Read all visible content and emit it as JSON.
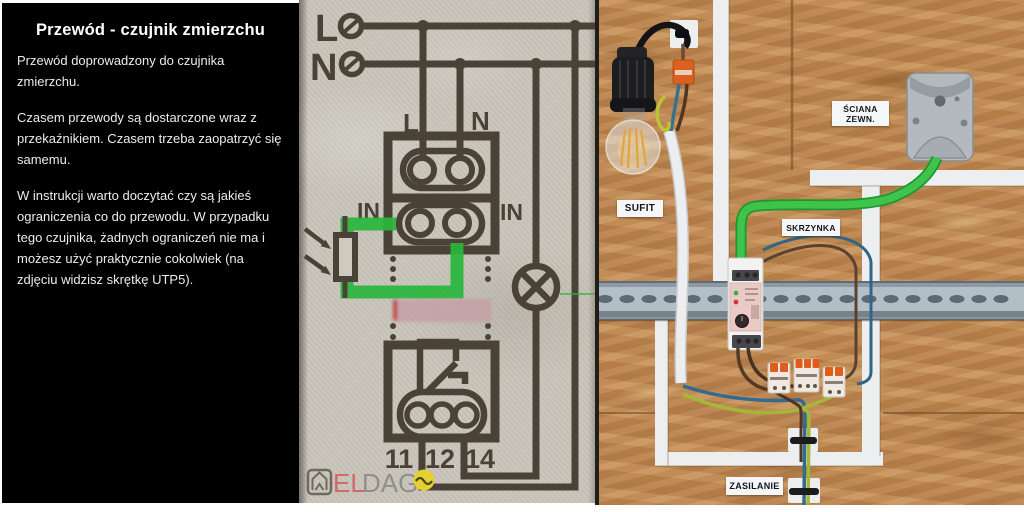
{
  "left_panel": {
    "title": "Przewód - czujnik zmierzchu",
    "paragraphs": [
      "Przewód doprowadzony do czujnika zmierzchu.",
      "Czasem przewody są dostarczone wraz z przekaźnikiem. Czasem trzeba zaopatrzyć się samemu.",
      "W instrukcji warto doczytać czy są jakieś ograniczenia co do przewodu. W przypadku tego czujnika, żadnych ograniczeń nie ma i możesz użyć praktycznie cokolwiek (na zdjęciu widzisz skrętkę UTP5)."
    ],
    "bg_color": "#000000",
    "text_color": "#ececec"
  },
  "diagram": {
    "terminal_l": "L",
    "terminal_n": "N",
    "relay_input_l": "L",
    "relay_input_n": "N",
    "in_left": "IN",
    "in_right": "IN",
    "contact_11": "11",
    "contact_12": "12",
    "contact_14": "14",
    "watermark": {
      "part1": "EL",
      "part2": "DAG"
    },
    "colors": {
      "paper": "#c8c4ba",
      "ink": "#4a4237",
      "highlight_green": "#29b63c",
      "redaction_pink": "#c69da4",
      "watermark_red": "#d06a66",
      "watermark_gray": "#918e87",
      "watermark_yellow": "#e4d02f"
    }
  },
  "photo": {
    "labels": {
      "wall_line1": "ŚCIANA",
      "wall_line2": "ZEWN.",
      "ceiling": "SUFIT",
      "junction_box": "SKRZYNKA",
      "power": "ZASILANIE"
    },
    "colors": {
      "osb_board": "#c28b55",
      "tape_white": "#eceef0",
      "utp_cable_green": "#3ec44b",
      "din_rail_gray": "#b3bfc7",
      "wago_orange": "#e05c1a",
      "relay_label_pink": "#e9cac6"
    }
  }
}
